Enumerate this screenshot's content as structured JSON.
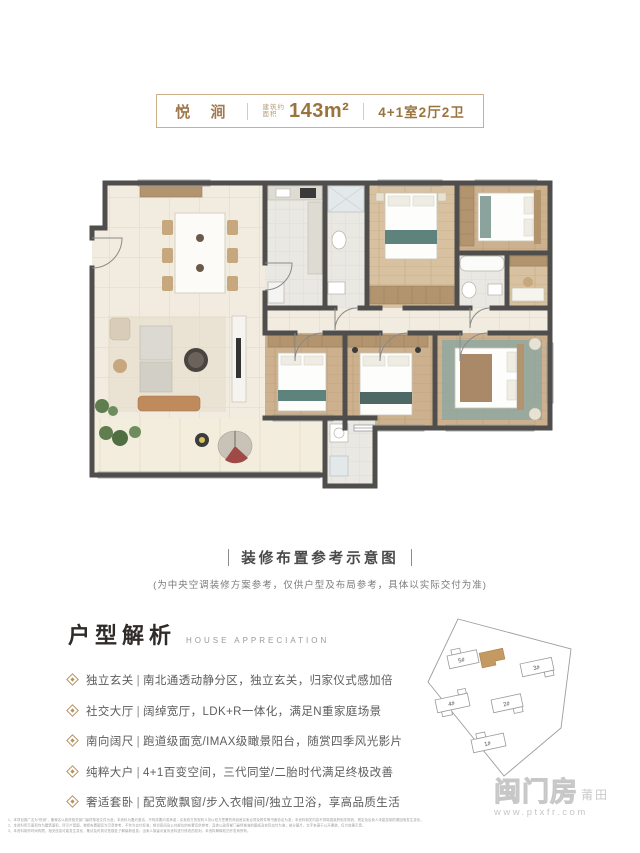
{
  "header": {
    "project_name": "悦 涧",
    "area_prefix_top": "建筑约",
    "area_prefix_bottom": "面积",
    "area_value": "143m²",
    "unit_layout": "4+1室2厅2卫"
  },
  "caption": {
    "title": "装修布置参考示意图",
    "note": "(为中央空调装修方案参考，仅供户型及布局参考，具体以实际交付为准)"
  },
  "analysis": {
    "title": "户型解析",
    "subtitle": "HOUSE APPRECIATION",
    "bullets": [
      {
        "tag": "独立玄关",
        "sep": "|",
        "text": "南北通透动静分区，独立玄关，归家仪式感加倍"
      },
      {
        "tag": "社交大厅",
        "sep": "|",
        "text": "阔绰宽厅，LDK+R一体化，满足N重家庭场景"
      },
      {
        "tag": "南向阔尺",
        "sep": "|",
        "text": "跑道级面宽/IMAX级瞰景阳台，随赏四季风光影片"
      },
      {
        "tag": "纯粹大户",
        "sep": "|",
        "text": "4+1百变空间，三代同堂/二胎时代满足终极改善"
      },
      {
        "tag": "奢适套卧",
        "sep": "|",
        "text": "配宽敞飘窗/步入衣帽间/独立卫浴，享高品质生活"
      }
    ]
  },
  "siteplan": {
    "buildings": [
      "5#",
      "3#",
      "2#",
      "4#",
      "1#"
    ],
    "highlight_color": "#c49a62"
  },
  "watermark": {
    "logo": "闽门房",
    "region": "莆田",
    "url": "www.ptxfr.com"
  },
  "disclaimer": {
    "lines": [
      "1、本项目推广名为“悦涧”，备案名以政府相关部门最终核准文件为准；本资料为要约邀请，不构成要约或承诺，买卖双方的权利义务以双方签署的商品房买卖合同及附件等书面协议为准；本资料相关内容不排除因政府相关规划、规定及出卖人未能控制的原因而发生变化。",
      "2、本资料所示面积均为建筑面积，所示户型图、装修布置图仅为示意参考，不作为交付标准；相邻房间及公共部位的布置仅供参考，具体以政府部门最终核准的图纸及实际交付为准；部分图片、文字来源于公开渠道，仅为效果示意。",
      "3、本资料制作时间有限，相关信息可能发生变化，敬请及时到访售楼处了解最新信息；出卖人保留对宣传资料进行修改的权利，本资料解释权归开发商所有。"
    ]
  }
}
